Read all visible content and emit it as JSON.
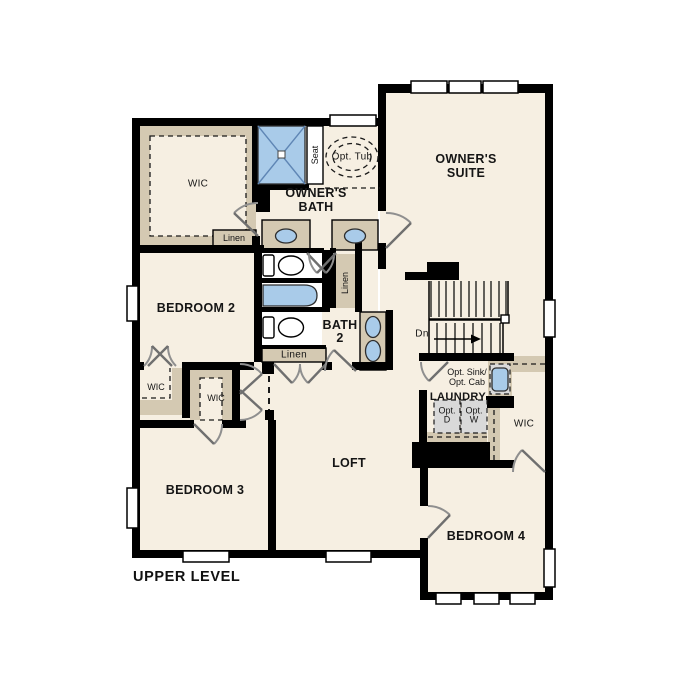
{
  "title": "UPPER LEVEL",
  "colors": {
    "floor": "#f6efe2",
    "wall": "#000000",
    "cabinet": "#d4c9b2",
    "fixture": "#a9cbe9",
    "appliance": "#d9d9d9"
  },
  "labels": {
    "upper_level": "UPPER LEVEL",
    "wic_owner": "WIC",
    "linen_owner": "Linen",
    "seat": "Seat",
    "opt_tub": "Opt. Tub",
    "owners_bath": "OWNER'S\nBATH",
    "owners_suite": "OWNER'S\nSUITE",
    "bedroom2": "BEDROOM 2",
    "linen_vertical": "Linen",
    "bath2": "BATH\n2",
    "linen_hall": "Linen",
    "stairs_dn": "Dn",
    "wic_bed2": "WIC",
    "wic_bed3": "WIC",
    "bedroom3": "BEDROOM 3",
    "loft": "LOFT",
    "opt_sink_cab": "Opt. Sink/\nOpt. Cab",
    "laundry": "LAUNDRY",
    "opt_dryer": "Opt.\nD",
    "opt_washer": "Opt.\nW",
    "wic_bed4": "WIC",
    "bedroom4": "BEDROOM 4"
  }
}
